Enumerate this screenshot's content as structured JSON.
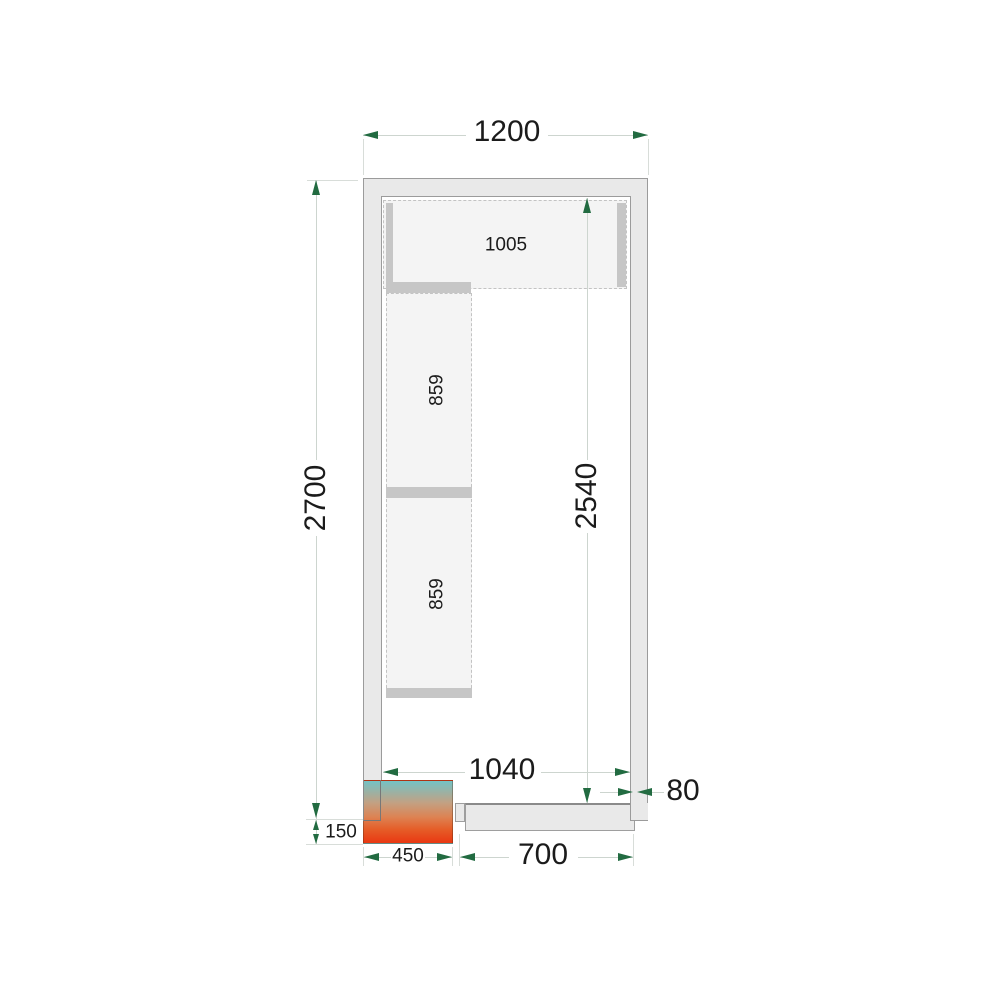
{
  "diagram": {
    "type": "cold-room-floor-plan",
    "dims": {
      "overall_width": "1200",
      "overall_depth": "2700",
      "inner_depth": "2540",
      "inner_width": "1040",
      "wall_thickness": "80",
      "unit_overhang": "150",
      "unit_width": "450",
      "door_clearance": "700",
      "shelf_top": "1005",
      "shelf_left_upper": "859",
      "shelf_left_lower": "859"
    },
    "colors": {
      "arrow_green": "#226b41",
      "dim_line": "#cdd5cf",
      "wall_fill": "#e9e9e9",
      "wall_line": "#9b9b9b",
      "shelf_fill": "#f4f4f4",
      "shelf_bar": "#c6c6c6",
      "unit_gradient": [
        "#74c2c4",
        "#c2a183",
        "#dd8353",
        "#e55d28",
        "#e93812"
      ]
    }
  }
}
